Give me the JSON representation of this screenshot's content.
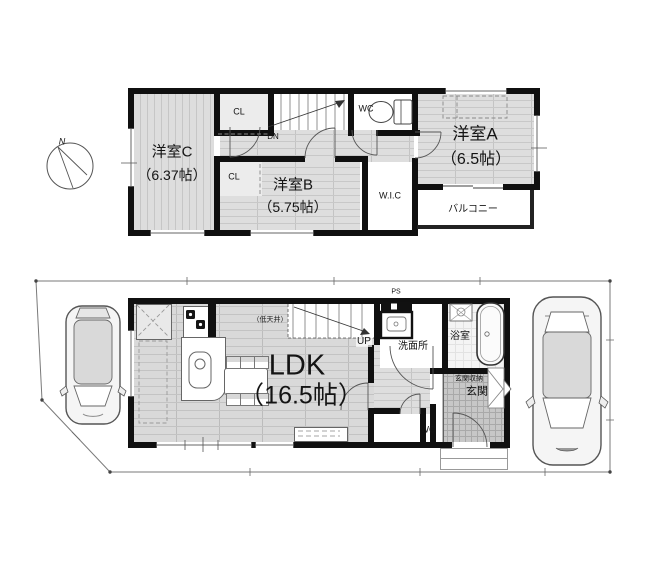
{
  "compass": {
    "north": "N"
  },
  "f2": {
    "room_c_name": "洋室C",
    "room_c_size": "（6.37帖）",
    "room_b_name": "洋室B",
    "room_b_size": "（5.75帖）",
    "room_a_name": "洋室A",
    "room_a_size": "（6.5帖）",
    "cl_top": "CL",
    "cl_b": "CL",
    "dn": "DN",
    "wc": "WC",
    "wic": "W.I.C",
    "balcony": "バルコニー"
  },
  "f1": {
    "ldk_name": "LDK",
    "ldk_size": "（16.5帖）",
    "low_ceiling": "（低天井）",
    "up": "UP",
    "ps": "PS",
    "washroom": "洗面所",
    "bathroom": "浴室",
    "entrance_storage": "玄関収納",
    "entrance": "玄関",
    "wc": "WC"
  },
  "colors": {
    "wall": "#101010",
    "floor_light": "#dedede",
    "floor_line": "#c8c8c8",
    "entrance_tile": "#c7c7c7",
    "boundary": "#7a7a7a",
    "background": "#ffffff"
  }
}
